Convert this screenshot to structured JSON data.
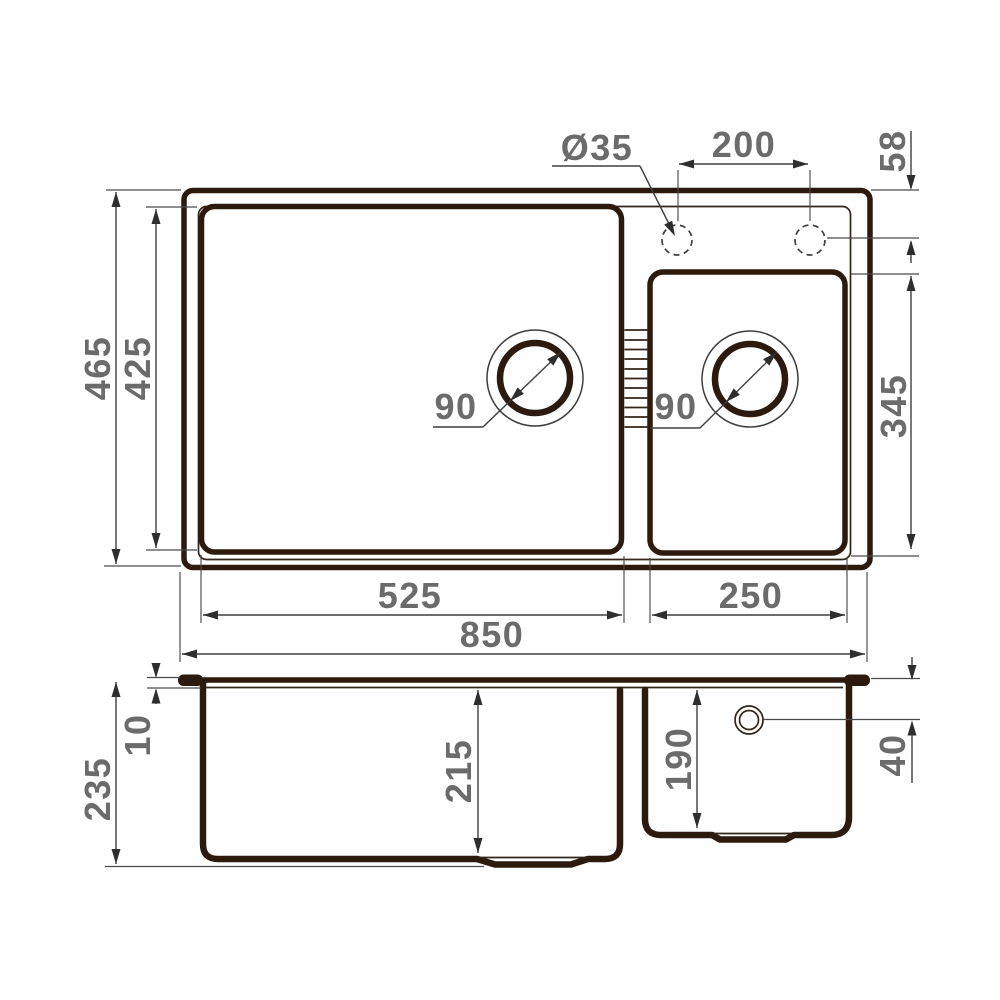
{
  "drawing": {
    "type": "kitchen sink dimensional drawing, top view and front section view",
    "colors": {
      "product_line": "#2b1a0d",
      "dimension_line": "#3e3e3e",
      "dim_text": "#6b6b6b",
      "background": "#ffffff"
    },
    "top_view": {
      "overall_length": "850",
      "main_bowl_length": "525",
      "second_bowl_length": "250",
      "overall_width": "465",
      "main_bowl_width": "425",
      "second_bowl_width": "345",
      "tap_hole_diameter": "Ø35",
      "tap_hole_spacing": "200",
      "tap_hole_edge_offset": "58",
      "main_drain_diameter": "90",
      "second_drain_diameter": "90"
    },
    "side_view": {
      "overall_height": "235",
      "rim_thickness": "10",
      "main_bowl_depth": "215",
      "second_bowl_depth": "190",
      "overflow_offset": "40"
    }
  }
}
